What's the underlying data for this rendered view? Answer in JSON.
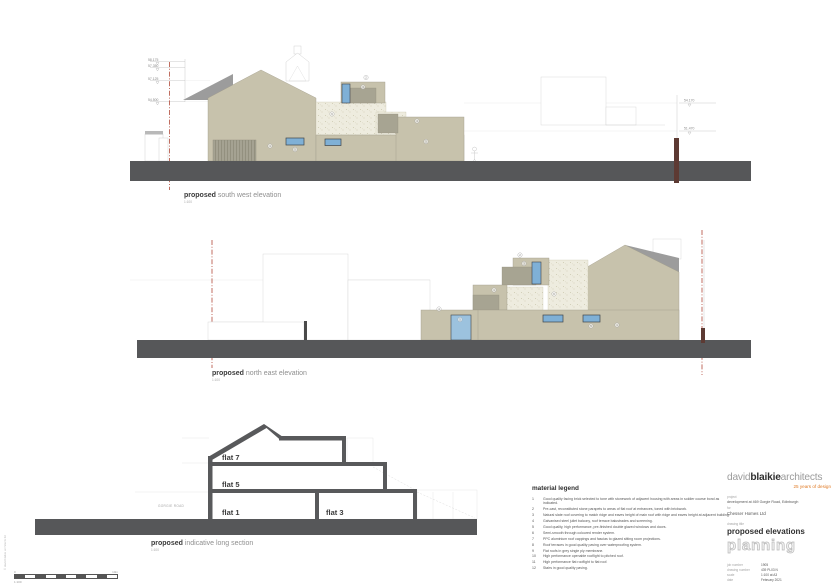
{
  "colors": {
    "ground_band": "#565759",
    "facade_beige": "#c7c2ac",
    "stone_render": "#eeecdf",
    "roof_grey": "#9c9c9c",
    "balcony_grey": "#a7a492",
    "window_blue": "#7fb0d6",
    "boundary_red": "#b14a3a",
    "post_maroon": "#5d3a33",
    "section_dark": "#58595b",
    "brand_orange": "#e07b26"
  },
  "elevation_sw": {
    "label_bold": "proposed",
    "label_rest": " south west elevation",
    "scale": "1:100",
    "levels_left": [
      "58.175",
      "57.350",
      "57.125",
      "54.500"
    ],
    "levels_right": [
      "54.170",
      "51.470"
    ],
    "markers": [
      "1",
      "5",
      "6",
      "3",
      "2",
      "4",
      "5"
    ]
  },
  "elevation_ne": {
    "label_bold": "proposed",
    "label_rest": " north east elevation",
    "scale": "1:100",
    "markers": [
      "4",
      "5",
      "1",
      "2",
      "3",
      "6",
      "5",
      "1"
    ]
  },
  "section": {
    "label_bold": "proposed",
    "label_rest": " indicative long section",
    "scale": "1:100",
    "road": "GORGIE ROAD",
    "flats": [
      "flat 7",
      "flat 5",
      "flat 1",
      "flat 3"
    ]
  },
  "scalebar": {
    "zero": "0",
    "ten": "10m",
    "ratio": "1:100"
  },
  "edge_note": "© david blaikie architects ltd",
  "legend": {
    "title": "material legend",
    "items": [
      {
        "n": "1",
        "text": "Good quality facing brick selected to tone with stonework of adjacent housing with areas in soldier course bond as indicated."
      },
      {
        "n": "2",
        "text": "Pre-cast, reconstituted stone parapets to areas of flat roof at entrances, toned with brickwork."
      },
      {
        "n": "3",
        "text": "Natural slate roof covering to match ridge and eaves height of main roof with ridge and eaves height at adjacent building."
      },
      {
        "n": "4",
        "text": "Galvanised steel juliet balcony, roof terrace balustrades and screening."
      },
      {
        "n": "5",
        "text": "Good quality, high performance, pre-finished double glazed windows and doors."
      },
      {
        "n": "6",
        "text": "Semi-smooth through coloured render system."
      },
      {
        "n": "7",
        "text": "PPC aluminium roof cappings and fascias to glazed sitting room projections."
      },
      {
        "n": "8",
        "text": "Roof terraces in good quality paving over waterproofing system."
      },
      {
        "n": "9",
        "text": "Flat roofs in grey single ply membrane."
      },
      {
        "n": "10",
        "text": "High performance openable rooflight to pitched roof."
      },
      {
        "n": "11",
        "text": "High performance flat rooflight to flat roof."
      },
      {
        "n": "12",
        "text": "Stairs in good quality paving."
      }
    ]
  },
  "title_block": {
    "firm_grey1": "david",
    "firm_bold": "blaikie",
    "firm_grey2": "architects",
    "tagline": "25 years of design",
    "project_label": "project",
    "project": "development at 469 Gorgie Road, Edinburgh",
    "for_label": "for",
    "client": "Chesser Homes Ltd",
    "drawing_title_label": "drawing title",
    "drawing_title": "proposed elevations",
    "status": "planning",
    "job_number_label": "job number",
    "job_number": "1905",
    "drawing_number_label": "drawing number",
    "drawing_number": "439 PL03 N",
    "scale_label": "scale",
    "scale": "1:100 at A3",
    "date_label": "date",
    "date": "February 2021",
    "address": "79 Constitution Street   Edinburgh   EH6 7AE",
    "contact": "T : 0131 553 7316     e : studio@davidblaikiearchitects.com"
  }
}
